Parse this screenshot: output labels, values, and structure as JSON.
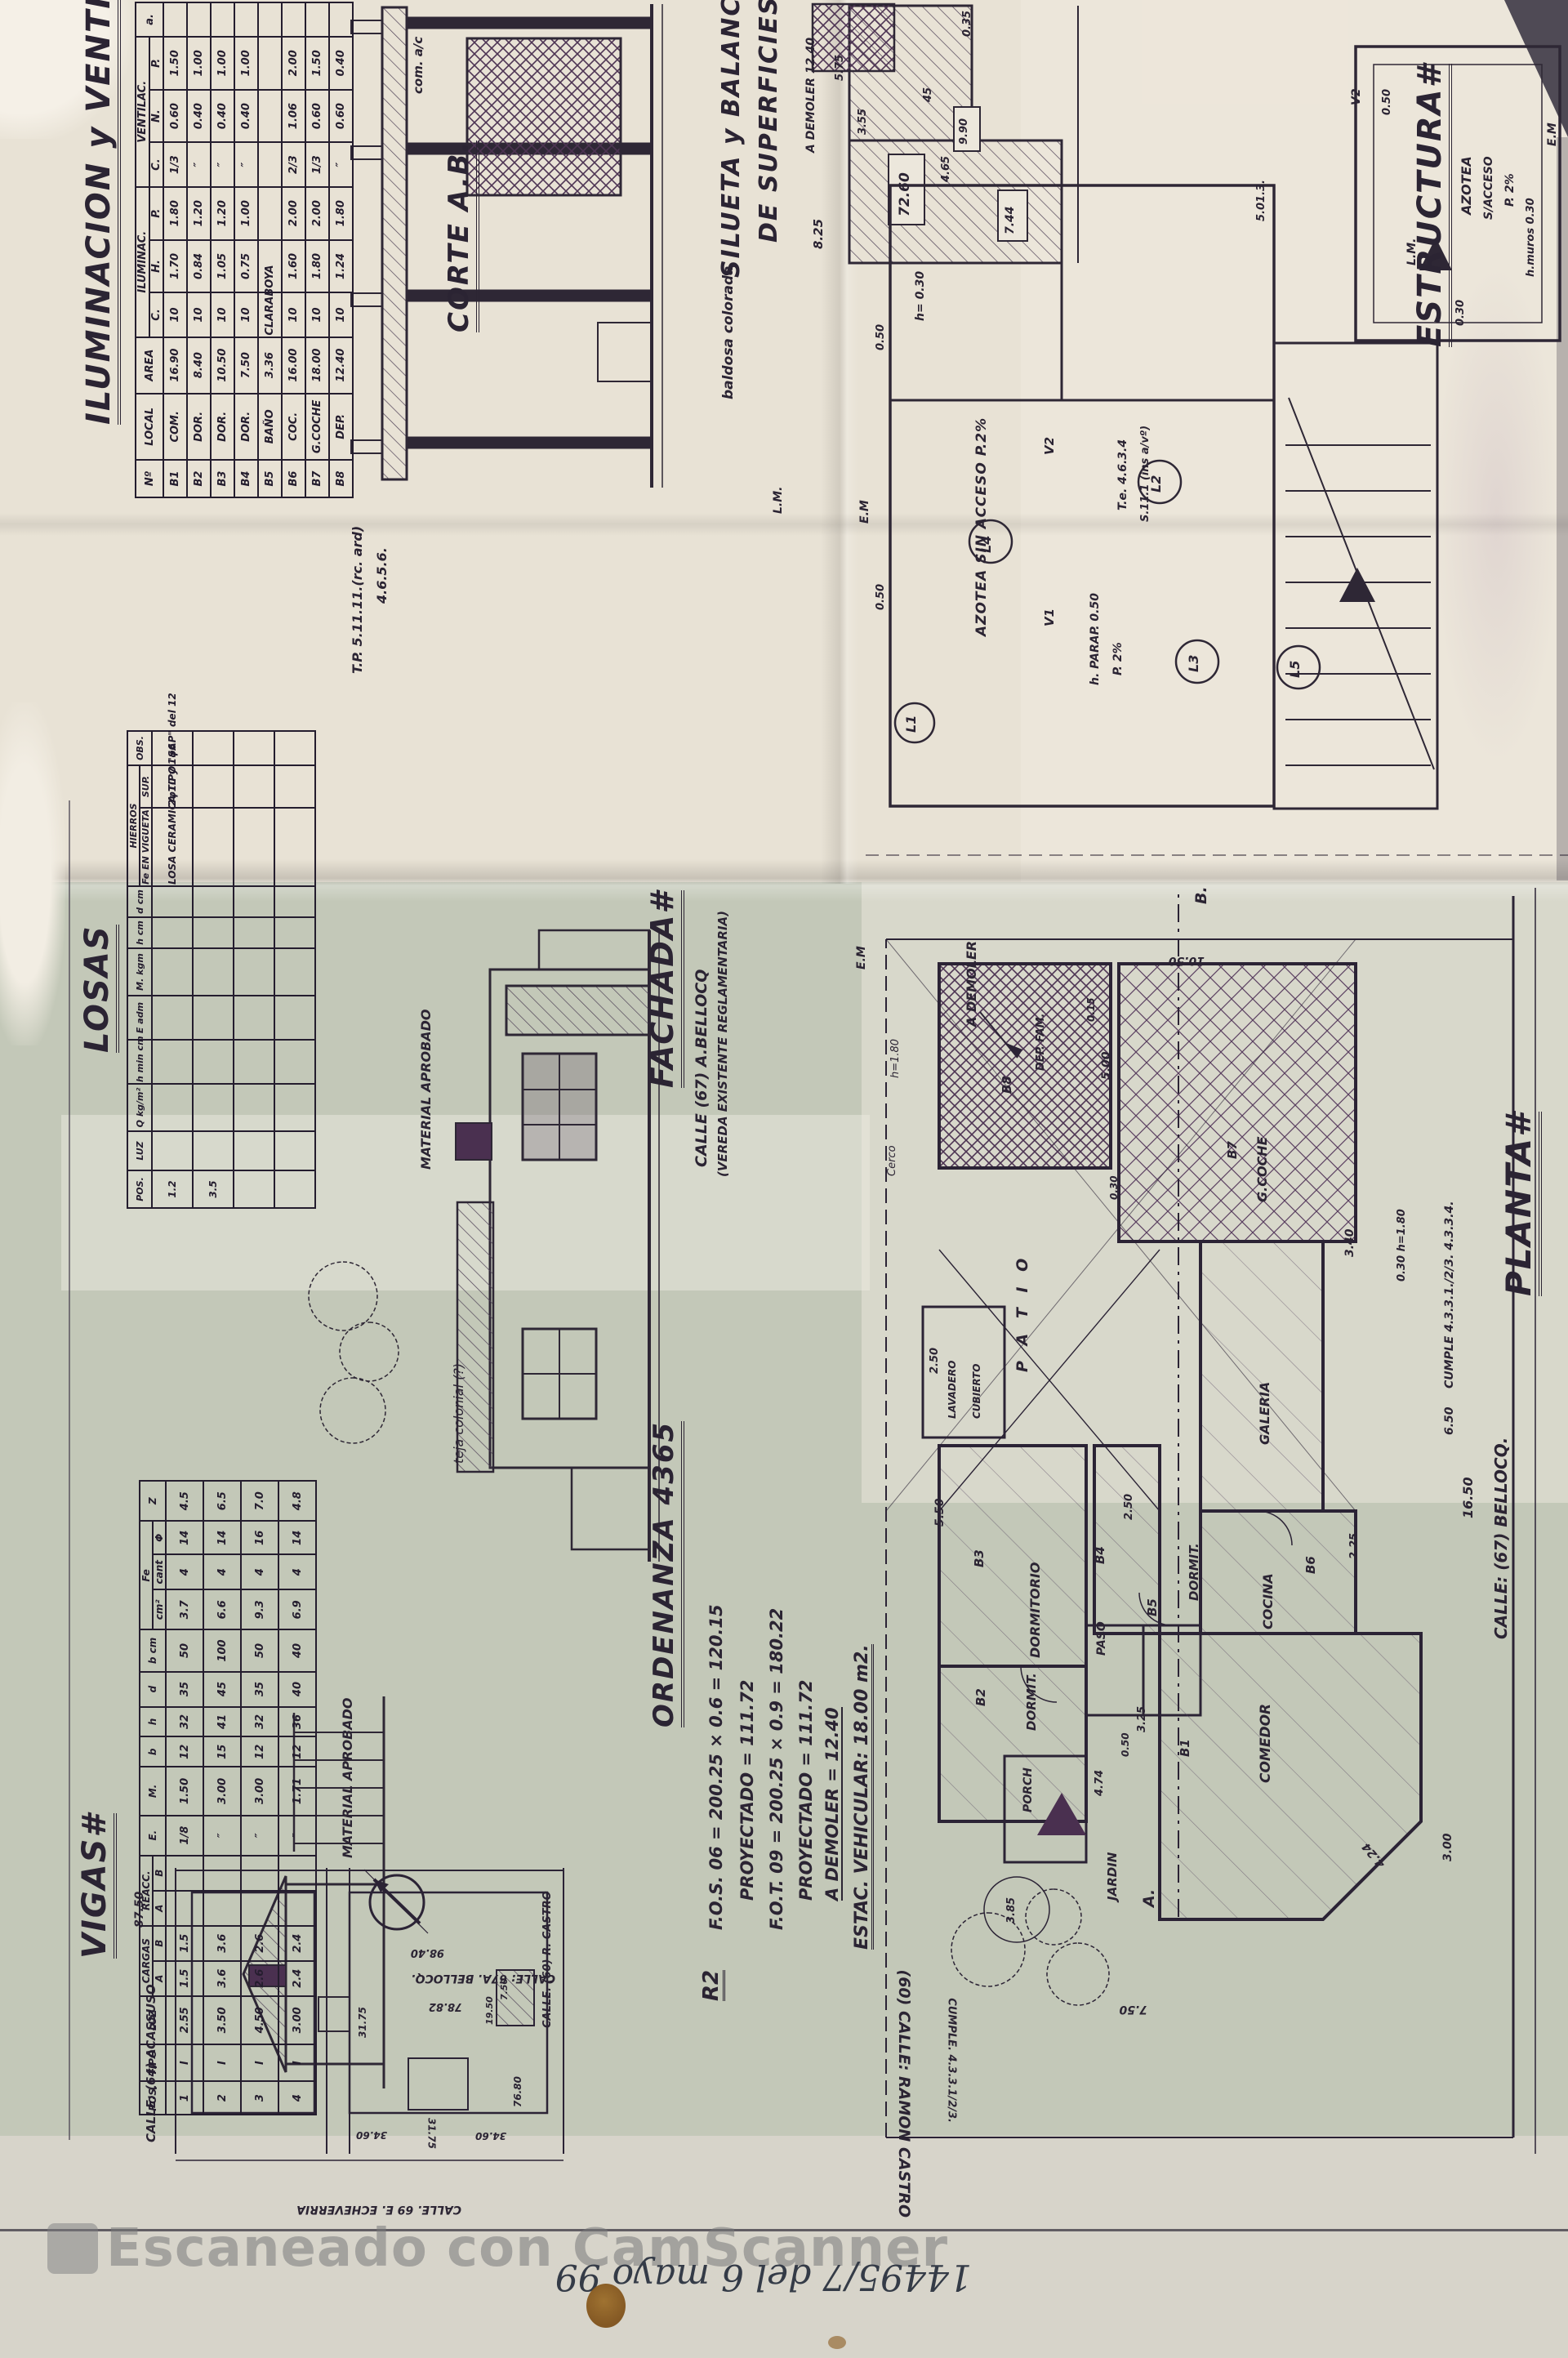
{
  "footer": {
    "watermark": "Escaneado con CamScanner",
    "handwritten": "14495/7  del 6 mayo 99"
  },
  "iluminacion": {
    "title": "ILUMINACION y VENTILA#",
    "group1": "ILUMINAC.",
    "group2": "VENTILAC.",
    "h": {
      "no": "Nº",
      "local": "LOCAL",
      "area": "AREA",
      "c": "C.",
      "hh": "H.",
      "p": "P.",
      "c2": "C.",
      "n": "N.",
      "p2": "P.",
      "obs": "a."
    },
    "rows": [
      [
        "B1",
        "COM.",
        "16.90",
        "10",
        "1.70",
        "1.80",
        "1/3",
        "0.60",
        "1.50",
        ""
      ],
      [
        "B2",
        "DOR.",
        "8.40",
        "10",
        "0.84",
        "1.20",
        "″",
        "0.40",
        "1.00",
        ""
      ],
      [
        "B3",
        "DOR.",
        "10.50",
        "10",
        "1.05",
        "1.20",
        "″",
        "0.40",
        "1.00",
        ""
      ],
      [
        "B4",
        "DOR.",
        "7.50",
        "10",
        "0.75",
        "1.00",
        "″",
        "0.40",
        "1.00",
        ""
      ],
      [
        "B5",
        "BAÑO",
        "3.36",
        "CLARABOYA",
        "",
        "",
        "",
        "",
        "",
        ""
      ],
      [
        "B6",
        "COC.",
        "16.00",
        "10",
        "1.60",
        "2.00",
        "2/3",
        "1.06",
        "2.00",
        ""
      ],
      [
        "B7",
        "G.COCHE",
        "18.00",
        "10",
        "1.80",
        "2.00",
        "1/3",
        "0.60",
        "1.50",
        ""
      ],
      [
        "B8",
        "DEP.",
        "12.40",
        "10",
        "1.24",
        "1.80",
        "″",
        "0.60",
        "0.40",
        ""
      ]
    ]
  },
  "losas": {
    "title": "LOSAS",
    "h": {
      "pos": "POS.",
      "luz": "LUZ",
      "q": "Q kg/m²",
      "hmin": "h min cm",
      "e": "E adm",
      "m": "M. kgm",
      "hcm": "h cm",
      "dcm": "d cm",
      "hierros": "HIERROS",
      "fe": "Fe EN VIGUETA",
      "sup": "SUP.",
      "obs": "OBS."
    },
    "rows": [
      [
        "1.2",
        "",
        "",
        "",
        "",
        "",
        "",
        "",
        "LOSA CERAMICA TIPO \"SAP\" del 12",
        "2φ10 y 1φ6",
        ""
      ],
      [
        "3.5",
        "",
        "",
        "",
        "",
        "",
        "",
        "",
        "",
        "",
        ""
      ],
      [
        "",
        "",
        "",
        "",
        "",
        "",
        "",
        "",
        "",
        "",
        ""
      ],
      [
        "",
        "",
        "",
        "",
        "",
        "",
        "",
        "",
        "",
        "",
        ""
      ]
    ]
  },
  "vigas": {
    "title": "VIGAS#",
    "h": {
      "pos": "POS.",
      "tipo": "TIPO",
      "luz": "LUZ",
      "cargas": "CARGAS",
      "reacc": "REACC.",
      "a": "A",
      "b": "B",
      "e": "E.",
      "m": "M.",
      "bb": "b",
      "hh": "h",
      "d": "d",
      "bcm": "b cm",
      "fe": "Fe",
      "cm2": "cm²",
      "cant": "cant",
      "fi": "Φ",
      "z": "Z"
    },
    "rows": [
      [
        "1",
        "I",
        "2.55",
        "1.5",
        "1.5",
        "",
        "",
        "1/8",
        "1.50",
        "12",
        "32",
        "35",
        "50",
        "3.7",
        "4",
        "14",
        "4.5"
      ],
      [
        "2",
        "I",
        "3.50",
        "3.6",
        "3.6",
        "",
        "",
        "″",
        "3.00",
        "15",
        "41",
        "45",
        "100",
        "6.6",
        "4",
        "14",
        "6.5"
      ],
      [
        "3",
        "I",
        "4.50",
        "2.6",
        "2.6",
        "",
        "",
        "″",
        "3.00",
        "12",
        "32",
        "35",
        "50",
        "9.3",
        "4",
        "16",
        "7.0"
      ],
      [
        "4",
        "I",
        "3.00",
        "2.4",
        "2.4",
        "",
        "",
        "″",
        "1.71",
        "12",
        "36",
        "40",
        "40",
        "6.9",
        "4",
        "14",
        "4.8"
      ]
    ]
  },
  "corte": {
    "title": "CORTE A.B.",
    "nota_tp": "T.P. 5.11.11.(rc. ard)",
    "nota_tp2": "4.6.5.6.",
    "com": "com. a/c",
    "baldosa": "baldosa colorada"
  },
  "silueta": {
    "t1": "SILUETA y BALANCE",
    "t2": "DE SUPERFICIES",
    "ademoler": "A DEMOLER 12.40",
    "a825": "8.25",
    "a7260": "72.60",
    "a744": "7.44",
    "a990": "9.90",
    "a575": "5.75",
    "a45": "45",
    "a355": "3.55",
    "a465": "4.65"
  },
  "estructura": {
    "title": "ESTRUCTURA#",
    "azotea": "AZOTEA SIN ACCESO P.2%",
    "v1": "V1",
    "v2": "V2",
    "v2b": "V2",
    "l1": "L1",
    "l2": "L2",
    "l3": "L3",
    "l4": "L4",
    "l5": "L5",
    "te": "T.e. 4.6.3.4",
    "te2": "S.11.1 (ins a/vº)",
    "hparap": "h. PARAP. 0.50",
    "p2": "P. 2%",
    "h030": "h= 0.30",
    "d050a": "0.50",
    "d050b": "0.50",
    "d050c": "0.50",
    "d035": "0.35",
    "d030": "0.30",
    "d5013": "5.01.3.",
    "az2a": "AZOTEA",
    "az2b": "S/ACCESO",
    "az2c": "P. 2%",
    "hmuros": "h.muros 0.30",
    "lm": "L.M.",
    "lm2": "L.M.",
    "em": "E.M",
    "em2": "E.M",
    "em3": "E.M"
  },
  "ordenanza": {
    "title": "ORDENANZA 4365",
    "zone": "R2",
    "l1": "F.O.S. 06 = 200.25 × 0.6 =",
    "v1": "120.15",
    "l2": "PROYECTADO =",
    "v2": "111.72",
    "l3": "F.O.T. 09 = 200.25 × 0.9 =",
    "v3": "180.22",
    "l4": "PROYECTADO =",
    "v4": "111.72",
    "l5": "A DEMOLER =",
    "v5": "12.40",
    "estac": "ESTAC. VEHICULAR: 18.00 m2."
  },
  "fachada": {
    "title": "FACHADA#",
    "sub1": "CALLE (67) A.BELLOCQ",
    "sub2": "(VEREDA EXISTENTE REGLAMENTARIA)",
    "material1": "MATERIAL APROBADO",
    "material2": "MATERIAL APROBADO",
    "teja": "teja colonial (?)"
  },
  "planta": {
    "title": "PLANTA#",
    "rooms": {
      "b1": "B1",
      "comedor": "COMEDOR",
      "b2": "B2",
      "dormit2": "DORMIT.",
      "b3": "B3",
      "dormitorio": "DORMITORIO",
      "b4": "B4",
      "dormit4": "DORMIT.",
      "b5": "B5",
      "paso": "PASO",
      "b6": "B6",
      "cocina": "COCINA",
      "b7": "B7",
      "gcoche": "G.COCHE",
      "b8": "B8",
      "dep": "DEP. FAM.",
      "patio": "P A T I O",
      "jardin": "JARDIN",
      "galeria": "GALERIA",
      "lavadero": "LAVADERO",
      "cubierto": "CUBIERTO",
      "porch": "PORCH"
    },
    "notes": {
      "ademoler": "A DEMOLER",
      "cerco": "Cerco",
      "cercoh": "h=1.80",
      "cumple1": "CUMPLE 4.3.3.1./2/3. 4.3.3.4.",
      "cumple2": "CUMPLE. 4.3.3.1/2/3.",
      "h180": "0.30 h=1.80",
      "am": "A.",
      "bm": "B."
    },
    "dims": {
      "d1050": "10.50",
      "d500": "5.00",
      "d550": "5.50",
      "d250": "2.50",
      "d250b": "2.50",
      "d225": "2.25",
      "d340": "3.40",
      "d1650": "16.50",
      "d650": "6.50",
      "d750": "7.50",
      "d424": "4.24",
      "d300": "3.00",
      "d325": "3.25",
      "d050": "0.50",
      "d474": "4.74",
      "d385": "3.85",
      "d015": "0.15",
      "d030": "0.30"
    },
    "calles": {
      "bellocq": "CALLE: (67) BELLOCQ.",
      "castro": "(60) CALLE: RAMON CASTRO"
    }
  },
  "mapa": {
    "acassuso": "CALLE: (64) ACASSUSO",
    "echeverria": "CALLE. 69 E. ECHEVERRIA",
    "bellocq": "CALLE: 67A. BELLOCQ.",
    "castro": "CALLE. (60)  R. CASTRO",
    "d8750": "87.50",
    "d9840": "98.40",
    "d7882": "78.82",
    "d3175": "31.75",
    "d3175b": "31.75",
    "d3460": "34.60",
    "d3460b": "34.60",
    "d7680": "76.80",
    "d1950": "19.50",
    "d750": "7.50"
  }
}
